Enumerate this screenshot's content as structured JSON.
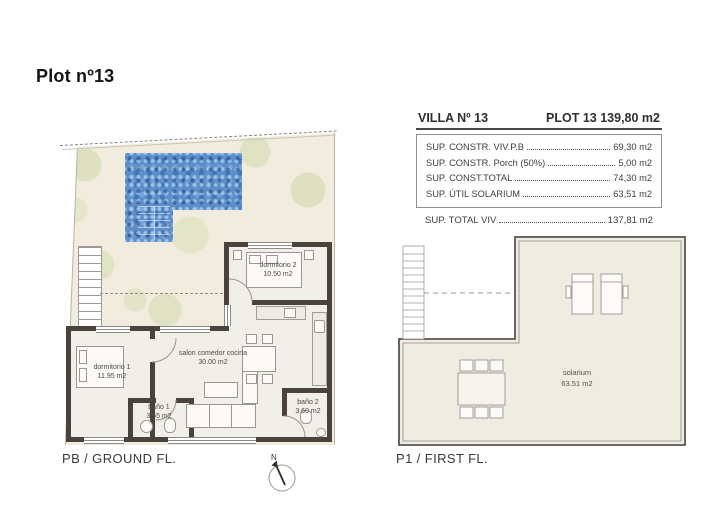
{
  "page": {
    "title": "Plot nº13"
  },
  "summary": {
    "villa": "VILLA Nº 13",
    "plot": "PLOT 13 139,80 m2",
    "rows": [
      {
        "label": "SUP. CONSTR. VIV.P.B",
        "value": "69,30 m2"
      },
      {
        "label": "SUP. CONSTR. Porch (50%)",
        "value": "5,00 m2"
      },
      {
        "label": "SUP. CONST.TOTAL",
        "value": "74,30 m2"
      },
      {
        "label": "SUP. ÚTIL SOLARIUM",
        "value": "63,51 m2"
      }
    ],
    "total": {
      "label": "SUP. TOTAL VIV",
      "value": "137,81 m2"
    }
  },
  "ground_floor": {
    "caption": "PB / GROUND FL.",
    "rooms": {
      "dormitorio2": {
        "name": "dormitorio 2",
        "area": "10.50 m2"
      },
      "dormitorio1": {
        "name": "dormitorio 1",
        "area": "11.95 m2"
      },
      "salon": {
        "name": "salon comedor cocina",
        "area": "30.00 m2"
      },
      "bano1": {
        "name": "baño 1",
        "area": "3.55 m2"
      },
      "bano2": {
        "name": "baño 2",
        "area": "3.60 m2"
      }
    }
  },
  "first_floor": {
    "caption": "P1 / FIRST FL.",
    "solarium": {
      "name": "solarium",
      "area": "63.51 m2"
    }
  },
  "compass": {
    "label": "N"
  },
  "colors": {
    "pool_blue": "#5e8ec8",
    "wall_dark": "#4a433d",
    "garden_cream": "#f1ecdd",
    "floor_light": "#f1efe9",
    "tree_green": "#cdd8a8"
  }
}
